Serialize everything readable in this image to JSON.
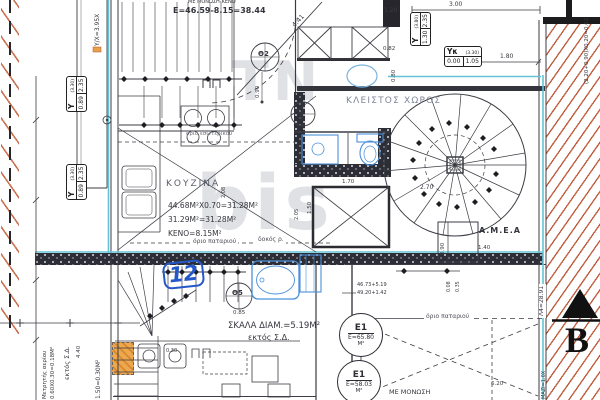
{
  "drawing": {
    "watermark": {
      "line1": "TN",
      "line2": "bis"
    },
    "texts": {
      "insulation_top": "ΜΕ ΜΟΝΩΣΗ-ΚΕΝΟ",
      "area_calc_top": "Ε=46.59-8.15=38.44",
      "closed_space": "ΚΛΕΙΣΤΟΣ ΧΩΡΟΣ",
      "kitchen": "ΚΟΥΖΙΝΑ",
      "kitchen_calc_1": "44.68M²X0.70=31.28M²",
      "kitchen_calc_2": "31.29M²=31.28M²",
      "kitchen_void": "ΚΕΝΟ=8.15M²",
      "loft_boundary_1": "όριο παταριού",
      "loft_boundary_2": "όριο παταριού",
      "beam_note": "δοκός ρ.",
      "inner_boundary": "όριο εσωτερικού",
      "stair_area": "ΣΚΑΛΑ ΔΙΑΜ.=5.19M²",
      "outside_building_1": "εκτός Σ.Δ.",
      "outside_building_2": "εκτός Σ.Δ.",
      "amea": "Α.Μ.Ε.Α",
      "insulation_bottom": "ΜΕ ΜΟΝΩΣΗ",
      "gas_meter": "Μετρητής αερίου",
      "gas_meter_calc": "0.60X0.30=0.18M²",
      "column_calc": "1.50=0.30M²",
      "left_wall_calc": "Υ/Χ=3.95Χ",
      "right_wall_calc": "(2.20+0.90)Χ0.20=0.62",
      "right_wall_len": "Λ4=28.91",
      "right_wall_small": "ΜΑΖΙ=1.0Χ",
      "sum_calc_1": "46.73+5.19",
      "sum_calc_2": "49.20+1.42",
      "section_marker": "B",
      "revision_mark": "12"
    },
    "door_tags": {
      "t2": "Θ2",
      "t4": "Θ4",
      "t5": "Θ5"
    },
    "area_tags": {
      "e1a": {
        "id": "Ε1",
        "value": "Ε=65.80",
        "unit": "Μ²"
      },
      "e1b": {
        "id": "Ε1",
        "value": "Ε=58.03",
        "unit": "Μ²"
      }
    },
    "level_boxes": {
      "yk": {
        "id": "Yκ",
        "paren": "(3.30)",
        "a": "0.00",
        "b": "1.05"
      },
      "y_right": {
        "id": "Y",
        "paren": "(3.80)",
        "a": "1.30",
        "b": "2.35"
      },
      "y_left_1": {
        "id": "Y",
        "paren": "(3.30)",
        "a": "0.89",
        "b": "2.35"
      },
      "y_left_2": {
        "id": "Y",
        "paren": "(3.30)",
        "a": "0.89",
        "b": "2.35"
      }
    },
    "dims": {
      "d300": "3.00",
      "d120": "1.20",
      "d082": "0.82",
      "d080": "0.80",
      "d180": "1.80",
      "d441": "4.41",
      "d090a": "0.90",
      "d170": "1.70",
      "d150": "1.50",
      "d270": "2.70",
      "d208": "2.08",
      "d205": "2.05",
      "d090b": "0.90",
      "d140": "1.40",
      "d008": "0.08",
      "d035": "0.35",
      "d085": "0.85",
      "d620": "6.20",
      "d030": "0.30",
      "d440": "4.40"
    },
    "colors": {
      "accent_cyan": "#62c4d6",
      "hatch_red": "#c06040",
      "wall_dark": "#2c2d35",
      "fixture_blue": "#4a90d9",
      "column_orange": "#e8a04c",
      "mark_blue": "#2458c8"
    }
  }
}
